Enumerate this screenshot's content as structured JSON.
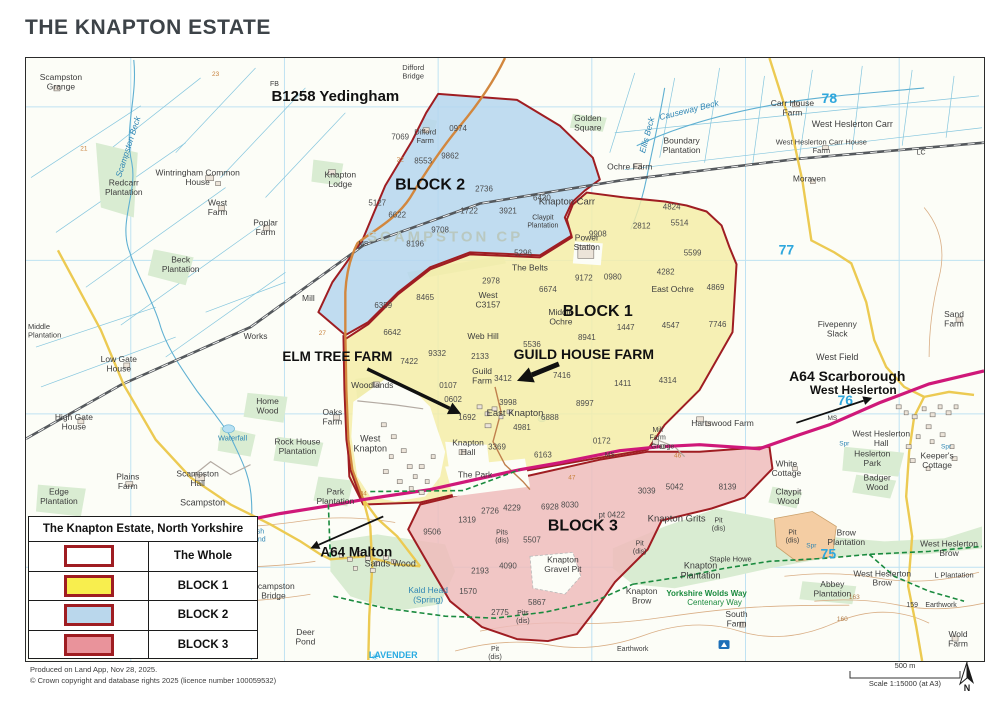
{
  "page": {
    "title": "THE KNAPTON ESTATE"
  },
  "colors": {
    "title_color": "#3d4348",
    "map_bg": "#fcfdf7",
    "grid": "#bfe2f2",
    "drain": "#85c6de",
    "water": "#5fb0d2",
    "water_fill": "#b7e0f2",
    "wood": "#d9ecd2",
    "contour": "#d9ae85",
    "railway": "#55595d",
    "a64": "#cf1879",
    "b_road": "#ecca52",
    "b1258": "#d2873e",
    "road_minor": "#b3aaa2",
    "boundary": "#9f1d22",
    "block1_fill": "#f5eda8",
    "block2_fill": "#b5d6ee",
    "block3_fill": "#efbcbc",
    "pit_fill": "#f4cda3",
    "building": "#ece4d9",
    "building_edge": "#77716b",
    "place": "#3c3c3c",
    "field_number": "#4c4c4c",
    "watermark": "#b9c8c0",
    "grid_number": "#2ea7dd",
    "path_green": "#1a8a3e"
  },
  "legend": {
    "title": "The Knapton Estate, North Yorkshire",
    "rows": [
      {
        "label": "The Whole",
        "fill": "#ffffff"
      },
      {
        "label": "BLOCK 1",
        "fill": "#f8ee4e"
      },
      {
        "label": "BLOCK 2",
        "fill": "#bad7ec"
      },
      {
        "label": "BLOCK 3",
        "fill": "#e9939b"
      }
    ]
  },
  "footer": {
    "line1": "Produced on Land App, Nov 28, 2025.",
    "line2": "© Crown copyright and database rights 2025 (licence number 100059532)"
  },
  "scalebar": {
    "distance_label": "500 m",
    "scale_label": "Scale 1:15000 (at A3)",
    "north_label": "N"
  },
  "map": {
    "watermark": {
      "t": "SCAMPSTON CP",
      "x": 420,
      "y": 184,
      "s": 15,
      "ls": 3
    },
    "grid_numbers": [
      {
        "t": "78",
        "x": 805,
        "y": 45
      },
      {
        "t": "77",
        "x": 762,
        "y": 197
      },
      {
        "t": "76",
        "x": 821,
        "y": 348
      },
      {
        "t": "75",
        "x": 804,
        "y": 502
      }
    ],
    "annotations": [
      {
        "t": "B1258 Yedingham",
        "x": 310,
        "y": 43,
        "s": 15
      },
      {
        "t": "BLOCK 2",
        "x": 405,
        "y": 132,
        "s": 16
      },
      {
        "t": "BLOCK 1",
        "x": 573,
        "y": 259,
        "s": 16
      },
      {
        "t": "BLOCK 3",
        "x": 558,
        "y": 474,
        "s": 16
      },
      {
        "t": "ELM TREE FARM",
        "x": 312,
        "y": 304,
        "s": 13.5
      },
      {
        "t": "GUILD HOUSE FARM",
        "x": 559,
        "y": 302,
        "s": 14
      },
      {
        "t": "A64 Scarborough",
        "x": 823,
        "y": 324,
        "s": 14
      },
      {
        "t": "West Heslerton",
        "x": 829,
        "y": 337,
        "s": 12
      },
      {
        "t": "A64 Malton",
        "x": 331,
        "y": 500,
        "s": 13.5
      }
    ],
    "arrows": [
      {
        "x1": 342,
        "y1": 312,
        "x2": 436,
        "y2": 357,
        "w": 3.5
      },
      {
        "x1": 534,
        "y1": 307,
        "x2": 492,
        "y2": 324,
        "w": 5
      },
      {
        "x1": 772,
        "y1": 366,
        "x2": 848,
        "y2": 341,
        "w": 1.8
      },
      {
        "x1": 358,
        "y1": 460,
        "x2": 285,
        "y2": 492,
        "w": 1.8
      }
    ],
    "road_numbers": [
      {
        "t": "21",
        "x": 58,
        "y": 93
      },
      {
        "t": "23",
        "x": 190,
        "y": 18
      },
      {
        "t": "22",
        "x": 375,
        "y": 104
      },
      {
        "t": "27",
        "x": 297,
        "y": 278
      },
      {
        "t": "34",
        "x": 338,
        "y": 439
      },
      {
        "t": "46",
        "x": 653,
        "y": 401
      },
      {
        "t": "47",
        "x": 547,
        "y": 423
      },
      {
        "t": "163",
        "x": 830,
        "y": 543,
        "c": "brown"
      },
      {
        "t": "160",
        "x": 818,
        "y": 565,
        "c": "brown"
      }
    ],
    "place_labels": [
      {
        "t": "Scampston\nGrange",
        "x": 35,
        "y": 22
      },
      {
        "t": "FB",
        "x": 249,
        "y": 28,
        "s": 7
      },
      {
        "t": "Difford\nBridge",
        "x": 388,
        "y": 12,
        "s": 7.5
      },
      {
        "t": "Knapton\nLodge",
        "x": 315,
        "y": 120
      },
      {
        "t": "Wintringham Common\nHouse",
        "x": 172,
        "y": 118
      },
      {
        "t": "Redcarr\nPlantation",
        "x": 98,
        "y": 128
      },
      {
        "t": "West\nFarm",
        "x": 192,
        "y": 148
      },
      {
        "t": "Poplar\nFarm",
        "x": 240,
        "y": 168
      },
      {
        "t": "Beck\nPlantation",
        "x": 155,
        "y": 205
      },
      {
        "t": "Middle\nPlantation",
        "x": 2,
        "y": 272,
        "anchor": "start",
        "s": 7.5
      },
      {
        "t": "Low Gate\nHouse",
        "x": 93,
        "y": 305
      },
      {
        "t": "Works",
        "x": 230,
        "y": 282
      },
      {
        "t": "Mill",
        "x": 283,
        "y": 244
      },
      {
        "t": "MS",
        "x": 338,
        "y": 188,
        "s": 6.5
      },
      {
        "t": "MS",
        "x": 808,
        "y": 363,
        "s": 6.5
      },
      {
        "t": "MS",
        "x": 585,
        "y": 400,
        "s": 6.5
      },
      {
        "t": "High Gate\nHouse",
        "x": 48,
        "y": 363
      },
      {
        "t": "Home\nWood",
        "x": 242,
        "y": 347
      },
      {
        "t": "Waterfall",
        "x": 207,
        "y": 384,
        "c": "blue",
        "s": 7.5
      },
      {
        "t": "Rock House\nPlantation",
        "x": 272,
        "y": 388
      },
      {
        "t": "Oaks\nFarm",
        "x": 307,
        "y": 358
      },
      {
        "t": "Woodlands",
        "x": 347,
        "y": 331
      },
      {
        "t": "Plains\nFarm",
        "x": 102,
        "y": 423
      },
      {
        "t": "Scampston\nHall",
        "x": 172,
        "y": 420
      },
      {
        "t": "Scampston",
        "x": 177,
        "y": 449,
        "s": 9
      },
      {
        "t": "Edge\nPlantation",
        "x": 33,
        "y": 438
      },
      {
        "t": "West\nKnapton",
        "x": 345,
        "y": 385,
        "s": 9
      },
      {
        "t": "Knapton\nHall",
        "x": 443,
        "y": 389
      },
      {
        "t": "The Park",
        "x": 450,
        "y": 421
      },
      {
        "t": "Park\nPlantation",
        "x": 310,
        "y": 438
      },
      {
        "t": "Sands Wood",
        "x": 365,
        "y": 510,
        "s": 9
      },
      {
        "t": "Scampston\nBridge",
        "x": 248,
        "y": 533
      },
      {
        "t": "Kald Head\n(Spring)",
        "x": 403,
        "y": 537,
        "c": "blue"
      },
      {
        "t": "Deer\nPond",
        "x": 280,
        "y": 579
      },
      {
        "t": "LAVENDER",
        "x": 368,
        "y": 602,
        "c": "#29abe2",
        "b": 1,
        "s": 9
      },
      {
        "t": "Fish\nPond",
        "x": 232,
        "y": 477,
        "c": "blue",
        "s": 7
      },
      {
        "t": "Difford\nFarm",
        "x": 400,
        "y": 77,
        "s": 7.5
      },
      {
        "t": "Golden\nSquare",
        "x": 563,
        "y": 63
      },
      {
        "t": "Ochre Farm",
        "x": 605,
        "y": 112
      },
      {
        "t": "Knapton Carr",
        "x": 542,
        "y": 147,
        "s": 9.5
      },
      {
        "t": "Claypit\nPlantation",
        "x": 518,
        "y": 162,
        "s": 7
      },
      {
        "t": "Causeway Beck",
        "x": 665,
        "y": 55,
        "c": "blue",
        "a": -14,
        "i": 1
      },
      {
        "t": "Ellis Beck",
        "x": 625,
        "y": 78,
        "c": "blue",
        "a": -75,
        "i": 1
      },
      {
        "t": "Scampston Beck",
        "x": 105,
        "y": 90,
        "c": "blue",
        "a": -72,
        "i": 1
      },
      {
        "t": "Boundary\nPlantation",
        "x": 657,
        "y": 86
      },
      {
        "t": "Carr House\nFarm",
        "x": 768,
        "y": 48
      },
      {
        "t": "West Heslerton Carr",
        "x": 828,
        "y": 69,
        "s": 9
      },
      {
        "t": "West Heslerton Carr House\nFarm",
        "x": 797,
        "y": 87,
        "s": 7.5
      },
      {
        "t": "LC",
        "x": 897,
        "y": 97,
        "s": 7
      },
      {
        "t": "Moraven",
        "x": 785,
        "y": 124
      },
      {
        "t": "Power\nStation",
        "x": 562,
        "y": 183
      },
      {
        "t": "The Belts",
        "x": 505,
        "y": 213
      },
      {
        "t": "West\nC3157",
        "x": 463,
        "y": 241
      },
      {
        "t": "Middle\nOchre",
        "x": 536,
        "y": 258
      },
      {
        "t": "East Ochre",
        "x": 648,
        "y": 235
      },
      {
        "t": "Web Hill",
        "x": 458,
        "y": 282
      },
      {
        "t": "Guild\nFarm",
        "x": 457,
        "y": 317
      },
      {
        "t": "East Knapton",
        "x": 490,
        "y": 359,
        "s": 9.5
      },
      {
        "t": "Fivepenny\nSlack",
        "x": 813,
        "y": 270
      },
      {
        "t": "West Field",
        "x": 813,
        "y": 303,
        "s": 9
      },
      {
        "t": "Sand\nFarm",
        "x": 930,
        "y": 260
      },
      {
        "t": "Hartswood Farm",
        "x": 698,
        "y": 369
      },
      {
        "t": "Mill\nFarm",
        "x": 633,
        "y": 375,
        "s": 7
      },
      {
        "t": "Grange",
        "x": 638,
        "y": 392,
        "s": 7
      },
      {
        "t": "White\nCottage",
        "x": 762,
        "y": 410
      },
      {
        "t": "West Heslerton\nHall",
        "x": 857,
        "y": 380
      },
      {
        "t": "Heslerton\nPark",
        "x": 848,
        "y": 400
      },
      {
        "t": "Keeper's\nCottage",
        "x": 913,
        "y": 402
      },
      {
        "t": "Badger\nWood",
        "x": 853,
        "y": 424
      },
      {
        "t": "Claypit\nWood",
        "x": 764,
        "y": 438
      },
      {
        "t": "Spr",
        "x": 820,
        "y": 389,
        "c": "blue",
        "s": 6.5
      },
      {
        "t": "Spr",
        "x": 922,
        "y": 392,
        "c": "blue",
        "s": 6.5
      },
      {
        "t": "Spr",
        "x": 787,
        "y": 491,
        "c": "blue",
        "s": 6.5
      },
      {
        "t": "Pit\n(dis)",
        "x": 768,
        "y": 478,
        "s": 7
      },
      {
        "t": "Brow\nPlantation",
        "x": 822,
        "y": 479
      },
      {
        "t": "West Heslerton\nBrow",
        "x": 925,
        "y": 490
      },
      {
        "t": "West Heslerton\nBrow",
        "x": 858,
        "y": 520
      },
      {
        "t": "Abbey\nPlantation",
        "x": 808,
        "y": 531
      },
      {
        "t": "L Plantation",
        "x": 930,
        "y": 521,
        "s": 7.5
      },
      {
        "t": "159",
        "x": 888,
        "y": 551,
        "s": 7
      },
      {
        "t": "Earthwork",
        "x": 917,
        "y": 551,
        "s": 7
      },
      {
        "t": "Wold\nFarm",
        "x": 934,
        "y": 581
      },
      {
        "t": "Knapton Grits",
        "x": 652,
        "y": 465,
        "s": 9.5
      },
      {
        "t": "Pit\n(dis)",
        "x": 694,
        "y": 466,
        "s": 7
      },
      {
        "t": "Pit\n(dis)",
        "x": 615,
        "y": 489,
        "s": 7
      },
      {
        "t": "Pits\n(dis)",
        "x": 477,
        "y": 478,
        "s": 7
      },
      {
        "t": "Knapton\nGravel Pit",
        "x": 538,
        "y": 506
      },
      {
        "t": "Knapton\nPlantation",
        "x": 676,
        "y": 512,
        "s": 9
      },
      {
        "t": "Staple Howe",
        "x": 706,
        "y": 505,
        "s": 7.5
      },
      {
        "t": "Knapton\nBrow",
        "x": 617,
        "y": 538
      },
      {
        "t": "Yorkshire Wolds Way",
        "x": 682,
        "y": 540,
        "c": "green",
        "s": 8,
        "b": 1
      },
      {
        "t": "Centenary Way",
        "x": 690,
        "y": 549,
        "c": "green",
        "s": 8
      },
      {
        "t": "South\nFarm",
        "x": 712,
        "y": 561
      },
      {
        "t": "Earthwork",
        "x": 608,
        "y": 595,
        "s": 7
      },
      {
        "t": "Pit\n(dis)",
        "x": 470,
        "y": 595,
        "s": 7
      },
      {
        "t": "Pits\n(dis)",
        "x": 498,
        "y": 559,
        "s": 7
      }
    ],
    "field_numbers": [
      {
        "t": "0974",
        "x": 433,
        "y": 73
      },
      {
        "t": "7069",
        "x": 375,
        "y": 82
      },
      {
        "t": "8553",
        "x": 398,
        "y": 106
      },
      {
        "t": "9862",
        "x": 425,
        "y": 101
      },
      {
        "t": "2736",
        "x": 459,
        "y": 134
      },
      {
        "t": "1722",
        "x": 444,
        "y": 156
      },
      {
        "t": "3921",
        "x": 483,
        "y": 156
      },
      {
        "t": "6430",
        "x": 517,
        "y": 143
      },
      {
        "t": "5127",
        "x": 352,
        "y": 148
      },
      {
        "t": "6622",
        "x": 372,
        "y": 160
      },
      {
        "t": "9708",
        "x": 415,
        "y": 175
      },
      {
        "t": "8196",
        "x": 390,
        "y": 189
      },
      {
        "t": "5296",
        "x": 498,
        "y": 198
      },
      {
        "t": "9908",
        "x": 573,
        "y": 179
      },
      {
        "t": "2812",
        "x": 617,
        "y": 171
      },
      {
        "t": "5514",
        "x": 655,
        "y": 168
      },
      {
        "t": "4824",
        "x": 647,
        "y": 152
      },
      {
        "t": "5599",
        "x": 668,
        "y": 198
      },
      {
        "t": "2978",
        "x": 466,
        "y": 226
      },
      {
        "t": "6674",
        "x": 523,
        "y": 235
      },
      {
        "t": "9172",
        "x": 559,
        "y": 223
      },
      {
        "t": "0980",
        "x": 588,
        "y": 222
      },
      {
        "t": "4282",
        "x": 641,
        "y": 217
      },
      {
        "t": "4869",
        "x": 691,
        "y": 233
      },
      {
        "t": "7746",
        "x": 693,
        "y": 270
      },
      {
        "t": "4547",
        "x": 646,
        "y": 271
      },
      {
        "t": "1447",
        "x": 601,
        "y": 273
      },
      {
        "t": "8465",
        "x": 400,
        "y": 243
      },
      {
        "t": "6359",
        "x": 358,
        "y": 251
      },
      {
        "t": "6642",
        "x": 367,
        "y": 278
      },
      {
        "t": "9332",
        "x": 412,
        "y": 299
      },
      {
        "t": "7422",
        "x": 384,
        "y": 307
      },
      {
        "t": "2133",
        "x": 455,
        "y": 302
      },
      {
        "t": "5536",
        "x": 507,
        "y": 290
      },
      {
        "t": "8941",
        "x": 562,
        "y": 283
      },
      {
        "t": "3412",
        "x": 478,
        "y": 324
      },
      {
        "t": "7416",
        "x": 537,
        "y": 321
      },
      {
        "t": "1411",
        "x": 598,
        "y": 329
      },
      {
        "t": "4314",
        "x": 643,
        "y": 326
      },
      {
        "t": "0107",
        "x": 423,
        "y": 331
      },
      {
        "t": "0602",
        "x": 428,
        "y": 345
      },
      {
        "t": "1692",
        "x": 442,
        "y": 363
      },
      {
        "t": "3998",
        "x": 483,
        "y": 348
      },
      {
        "t": "6888",
        "x": 525,
        "y": 363
      },
      {
        "t": "4981",
        "x": 497,
        "y": 373
      },
      {
        "t": "8997",
        "x": 560,
        "y": 349
      },
      {
        "t": "3369",
        "x": 472,
        "y": 393
      },
      {
        "t": "6163",
        "x": 518,
        "y": 401
      },
      {
        "t": "0172",
        "x": 577,
        "y": 387
      },
      {
        "t": "2726",
        "x": 465,
        "y": 457
      },
      {
        "t": "4229",
        "x": 487,
        "y": 454
      },
      {
        "t": "6928",
        "x": 525,
        "y": 453
      },
      {
        "t": "8030",
        "x": 545,
        "y": 451
      },
      {
        "t": "pt 0422",
        "x": 587,
        "y": 461
      },
      {
        "t": "1319",
        "x": 442,
        "y": 466
      },
      {
        "t": "9506",
        "x": 407,
        "y": 478
      },
      {
        "t": "5507",
        "x": 507,
        "y": 486
      },
      {
        "t": "3039",
        "x": 622,
        "y": 437
      },
      {
        "t": "5042",
        "x": 650,
        "y": 433
      },
      {
        "t": "8139",
        "x": 703,
        "y": 433
      },
      {
        "t": "2193",
        "x": 455,
        "y": 517
      },
      {
        "t": "4090",
        "x": 483,
        "y": 512
      },
      {
        "t": "1570",
        "x": 443,
        "y": 538
      },
      {
        "t": "5867",
        "x": 512,
        "y": 549
      },
      {
        "t": "2775",
        "x": 475,
        "y": 559
      }
    ]
  }
}
